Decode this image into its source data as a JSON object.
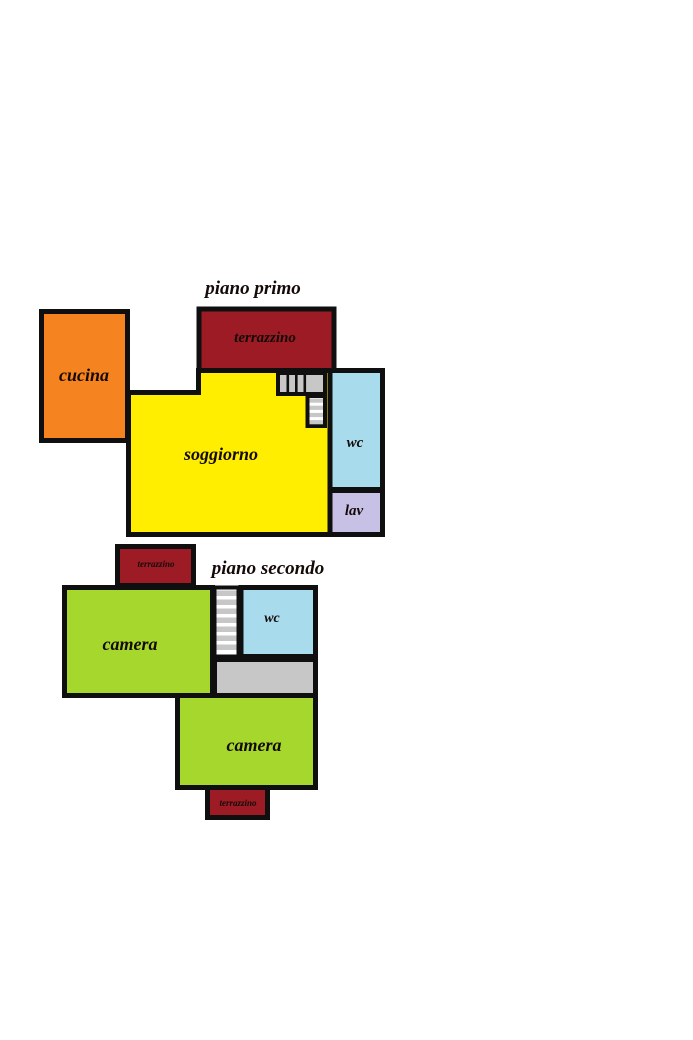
{
  "document": {
    "type": "floor-plan",
    "background": "#ffffff"
  },
  "colors": {
    "wall": "#0f0f0f",
    "orange": "#f5831f",
    "yellow": "#ffee00",
    "dark_red": "#9c1b24",
    "light_blue": "#a8dcec",
    "lavender": "#c8c1e6",
    "green": "#a6d72c",
    "gray": "#c7c7c7",
    "stair_step_gray": "#c7c7c7",
    "cucina_label": "#6e190d",
    "label_black": "#140a08"
  },
  "floor1": {
    "title": "piano primo",
    "rooms": {
      "cucina": "cucina",
      "terrazzino": "terrazzino",
      "soggiorno": "soggiorno",
      "wc": "wc",
      "lav": "lav"
    }
  },
  "floor2": {
    "title": "piano secondo",
    "rooms": {
      "terrazzino_top": "terrazzino",
      "camera_left": "camera",
      "wc": "wc",
      "camera_bottom": "camera",
      "terrazzino_bottom": "terrazzino"
    }
  }
}
